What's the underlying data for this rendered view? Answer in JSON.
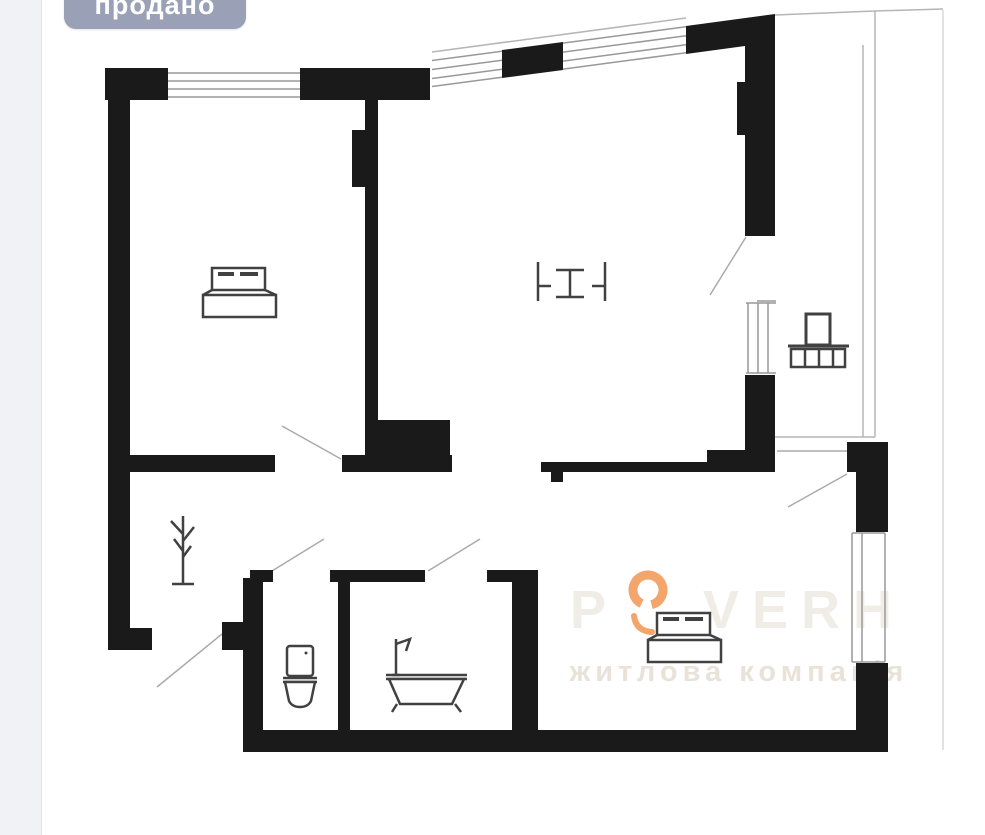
{
  "badge": {
    "label": "продано",
    "bg_color": "#9aa0b5",
    "text_color": "#ffffff"
  },
  "watermark": {
    "brand_first_letter": "P",
    "brand_rest": "VERH",
    "tagline": "житлова компанія",
    "letter_color": "#f0ede6",
    "tagline_color": "#e8e2d9",
    "ring_color": "#f3a56b"
  },
  "floorplan": {
    "type": "apartment-floor-plan",
    "wall_color": "#1a1a1a",
    "window_line_color": "#999999",
    "balcony_line_color": "#b5b5b5",
    "furniture_color": "#414141",
    "icons": [
      {
        "name": "bed-icon",
        "location": "top-left-room"
      },
      {
        "name": "dining-table-icon",
        "location": "top-middle-room"
      },
      {
        "name": "planter-icon",
        "location": "right-balcony"
      },
      {
        "name": "coat-rack-icon",
        "location": "hallway"
      },
      {
        "name": "toilet-icon",
        "location": "wc"
      },
      {
        "name": "bathtub-icon",
        "location": "bathroom"
      },
      {
        "name": "bed-icon",
        "location": "bottom-right-room"
      }
    ]
  }
}
